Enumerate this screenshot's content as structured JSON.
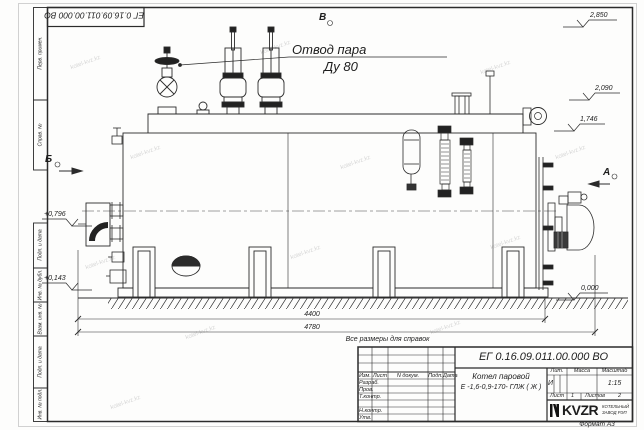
{
  "sheet": {
    "stamp_rotated": "ЕГ 0.16.09.011.00.000  ВО",
    "format_note": "Формат  А3"
  },
  "frame": {
    "col_perv_primen": "Перв. примен.",
    "col_sprav": "Справ. №",
    "col_podp_data1": "Подп. и дата",
    "col_inv_dubl": "Инв. № дубл.",
    "col_vzam_inv": "Взам. инв. №",
    "col_podp_data2": "Подп. и дата",
    "col_inv_podl": "Инв. № подл."
  },
  "drawing": {
    "callout": {
      "line1": "Отвод пара",
      "line2": "Ду 80"
    },
    "views": {
      "top": "В",
      "right": "А",
      "left": "Б"
    },
    "elevations": {
      "e1": "2,850",
      "e2": "2,090",
      "e3": "1,746",
      "e4": "0,000",
      "e5": "+0,796",
      "e6": "+0,143"
    },
    "dims": {
      "d1": "4400",
      "d2": "4780"
    },
    "note": "Все размеры для справок"
  },
  "title_block": {
    "doc_number": "ЕГ 0.16.09.011.00.000  ВО",
    "product_name_line1": "Котел паровой",
    "product_name_line2": "Е -1,6-0,9-170- ГЛЖ ( Ж )",
    "col_izm": "Изм.",
    "col_list": "Лист",
    "col_ndokum": "N докум.",
    "col_podp": "Подп.",
    "col_data": "Дата",
    "row_razrab": "Разраб.",
    "row_prov": "Пров.",
    "row_tkontr": "Т.контр.",
    "row_nkontr": "Н.контр.",
    "row_utv": "Утв.",
    "lit_header": "Лит.",
    "massa_header": "Масса",
    "masshtab_header": "Масштаб",
    "lit_value": "И",
    "masshtab_value": "1:15",
    "sheet_label": "Лист",
    "sheet_value": "1",
    "sheets_label": "Листов",
    "sheets_value": "2",
    "logo_text": "KVZR",
    "company_line1": "КОТЕЛЬНЫЙ",
    "company_line2": "ЗАВОД РЭП"
  },
  "watermark": {
    "text": "kotel-kvz.kz"
  }
}
